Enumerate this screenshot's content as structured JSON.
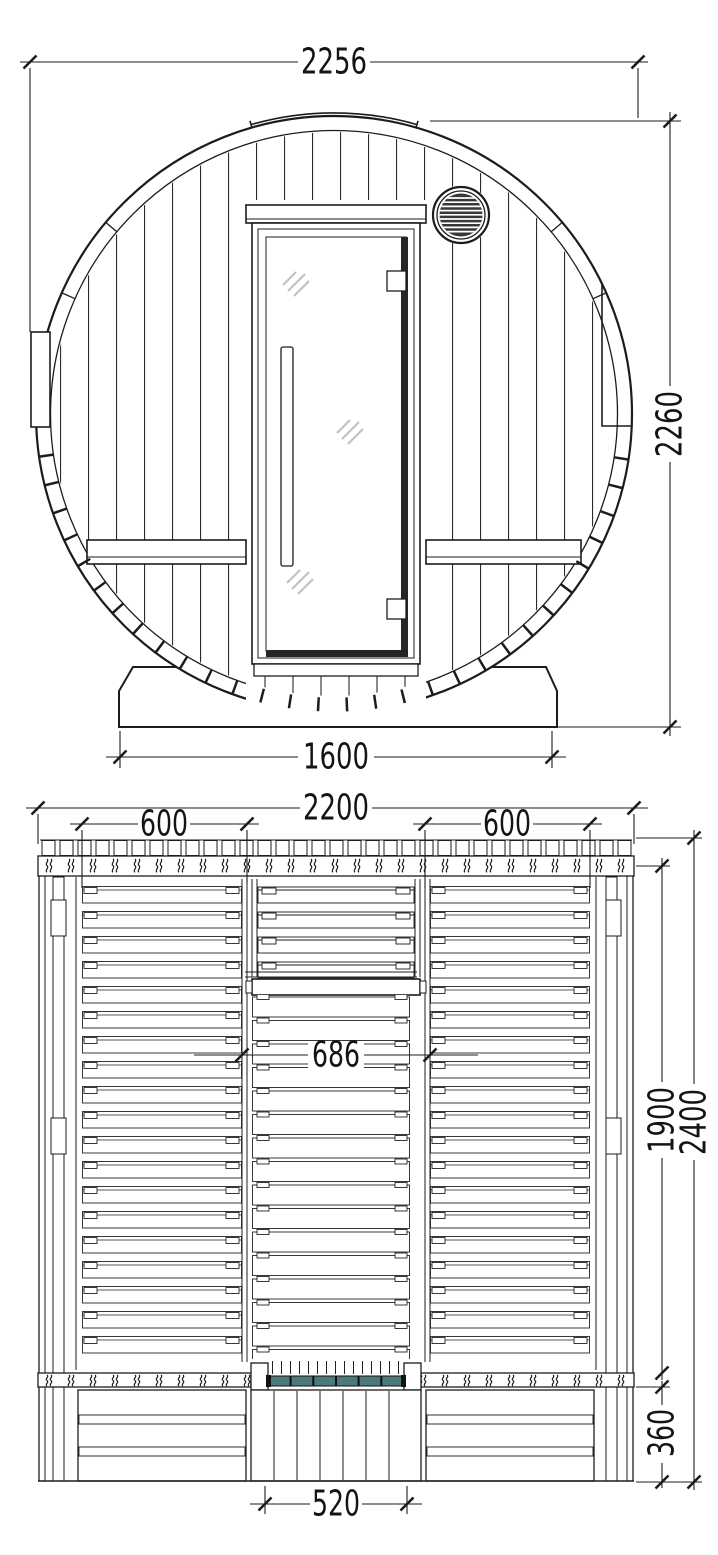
{
  "document": {
    "type": "technical dimensional drawing",
    "subject": "barrel sauna, front elevation and plan view"
  },
  "front_view": {
    "name": "front elevation",
    "dimensions": {
      "overall_width": "2256",
      "overall_height": "2260",
      "base_width": "1600"
    }
  },
  "plan_view": {
    "name": "plan view",
    "dimensions": {
      "overall_width": "2200",
      "left_bench_width": "600",
      "right_bench_width": "600",
      "aisle_width": "686",
      "cabin_depth": "1900",
      "overall_depth": "2400",
      "porch_depth": "360",
      "door_width": "520"
    }
  },
  "colors": {
    "background": "#ffffff",
    "line": "#1c1c1c",
    "glass_shine": "#c2c2c2",
    "door_glass_top_edge": "#4c7a78",
    "vent_dark": "#383838"
  }
}
